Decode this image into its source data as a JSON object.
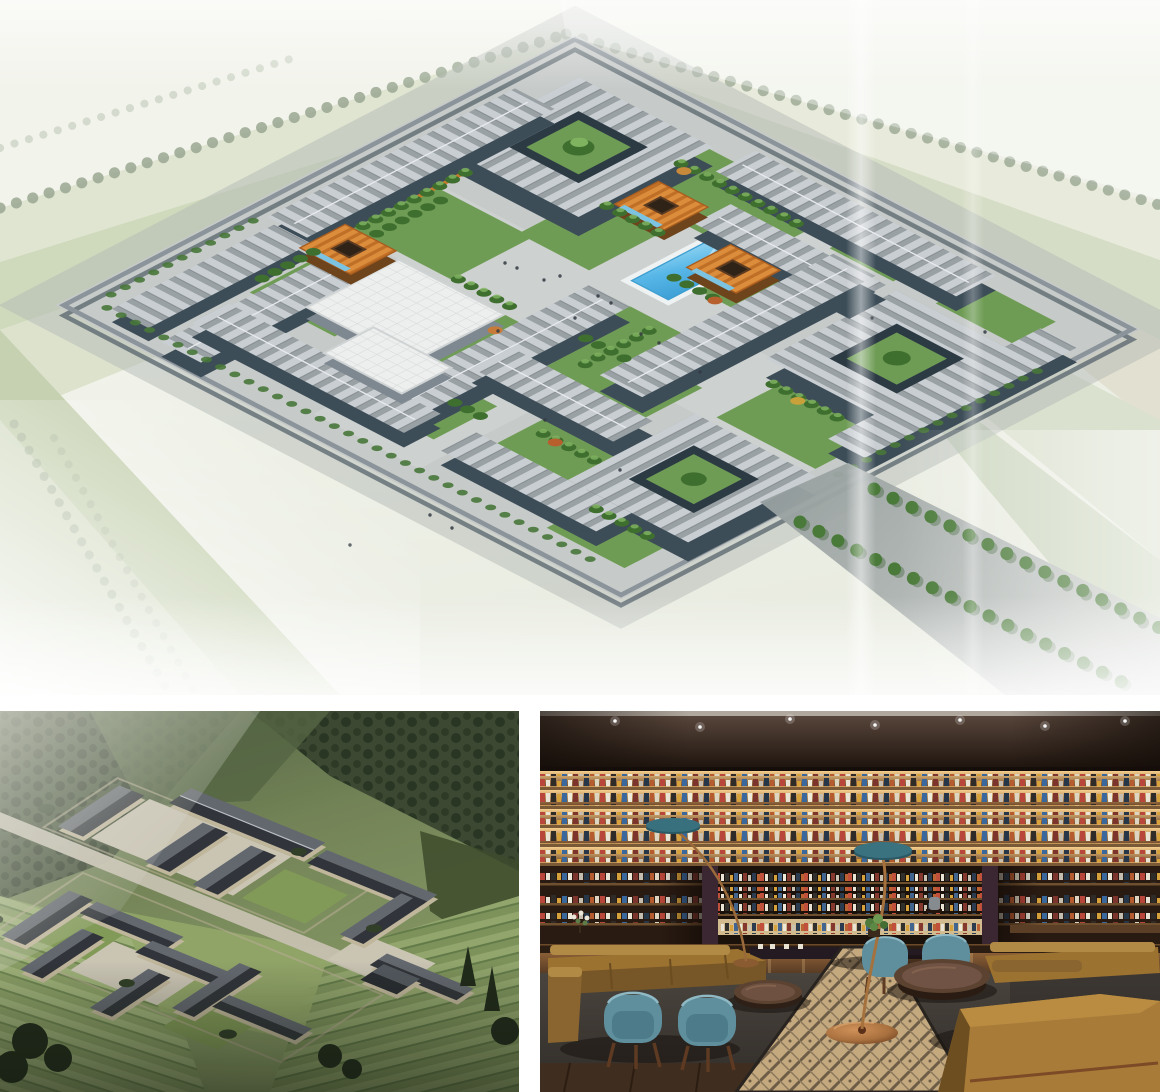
{
  "page": {
    "background": "#ffffff"
  },
  "collage": {
    "panels": [
      {
        "id": "campus-aerial",
        "kind": "architectural-rendering",
        "description": "Aerial rendering of a walled courtyard campus: gray striped-roof slab buildings, ring buildings with inner gardens, orange hip-roof pavilions, a blue swimming pool, green courtyards, tree-lined perimeter roads and a tree-flanked entry road leading to the lower right."
      },
      {
        "id": "village-aerial",
        "kind": "architectural-rendering",
        "description": "Aerial rendering of a traditional courtyard village with dark tiled gable roofs and beige stone walls, set among green forested mountains and terraced fields, with a stone path running through the middle."
      },
      {
        "id": "library-lounge",
        "kind": "interior-photo",
        "description": "Warmly lit library lounge: floor-to-ceiling backlit bookshelves, camel leather sofas, teal barrel armchairs, round wooden coffee tables, copper arc floor lamps with teal shades, dark carpet and a beige geometric runner."
      }
    ]
  },
  "theme": {
    "panel-gap": "#ffffff",
    "campus-sky": "#f6f7f1",
    "plaza-gray": "#c6cac8",
    "roof-gray": "#a7adb1",
    "facade-slate": "#3d4d58",
    "foliage": "#6f9c55",
    "foliage-dark": "#3f6f2f",
    "pool-blue": "#58b7e7",
    "pavilion-orange": "#d0802f",
    "mountain-green": "#6c7c57",
    "forest-dark": "#35452c",
    "terrace-light": "#a6ba81",
    "house-wall": "#cfc4a8",
    "house-roof": "#383d44",
    "stone-path": "#d6d0bf",
    "ceiling-brown": "#2a1c13",
    "shelf-glow": "#f4c87e",
    "wood-brown": "#6b4a2a",
    "sofa-camel": "#a87c38",
    "chair-teal": "#5f8f9d",
    "carpet-dark": "#413c37",
    "runner-beige": "#c4a97f",
    "copper": "#a9713f"
  }
}
